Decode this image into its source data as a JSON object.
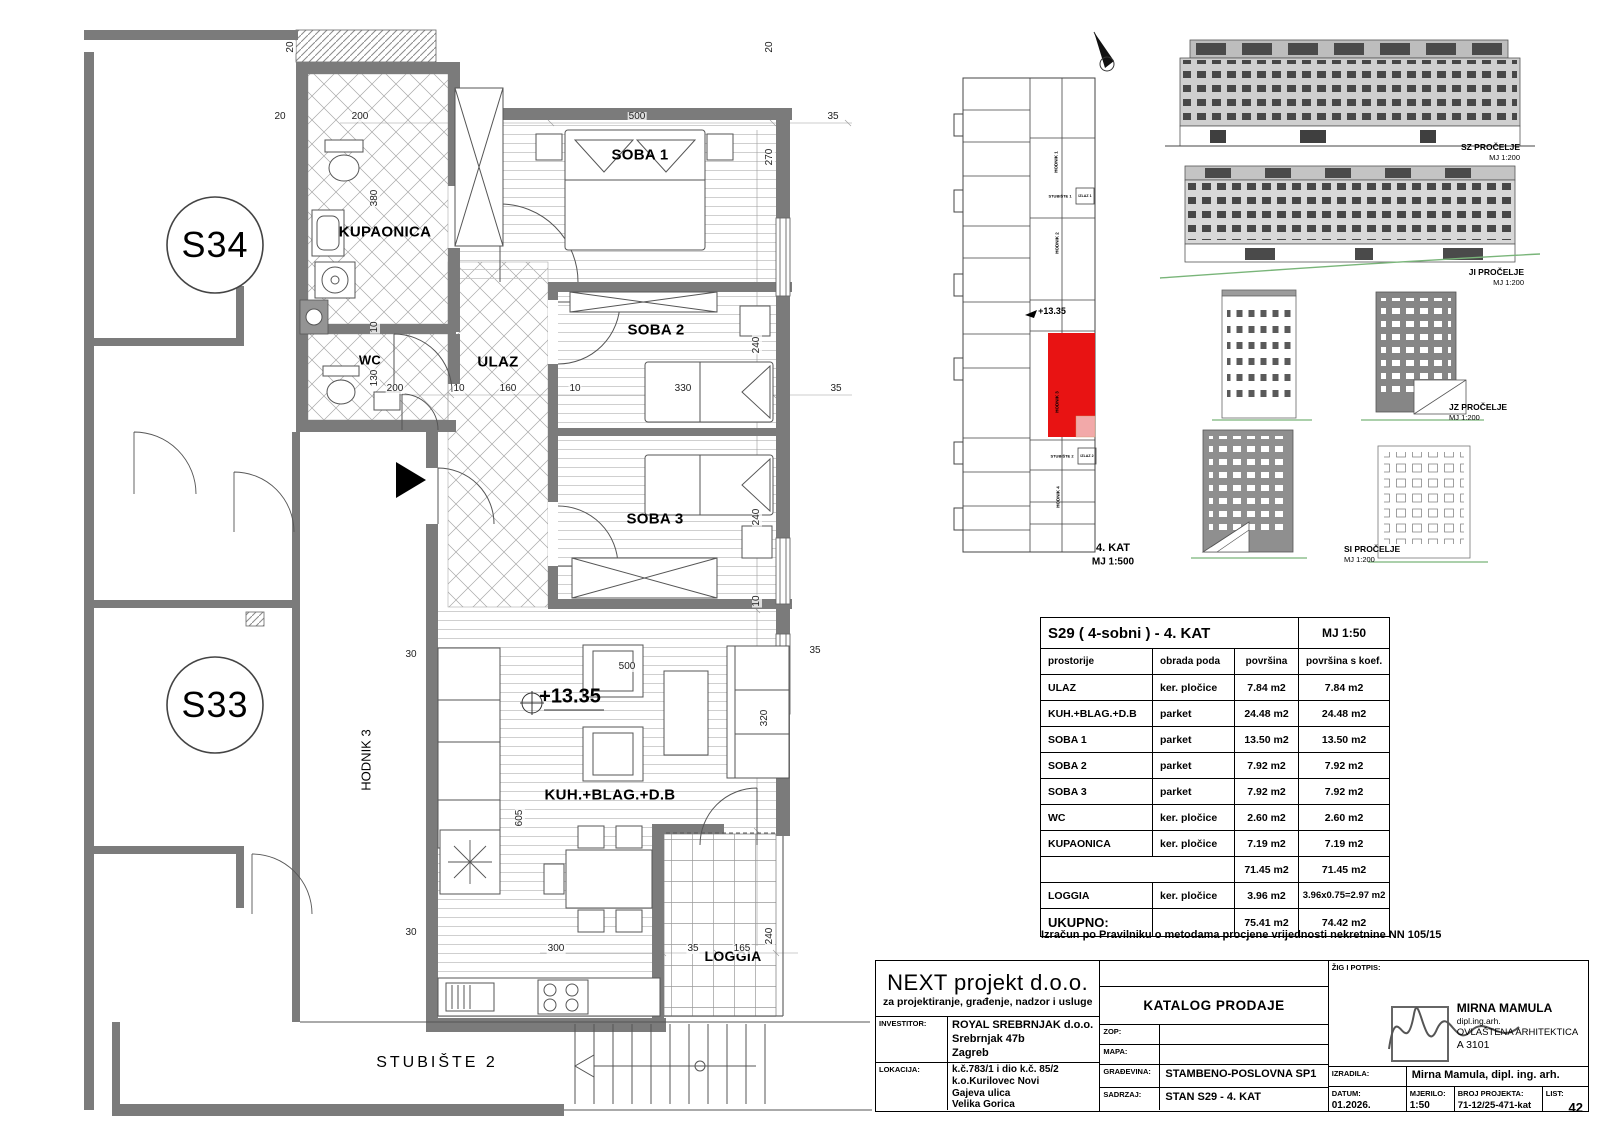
{
  "floor_plan": {
    "units": {
      "s34": "S34",
      "s33": "S33"
    },
    "rooms": {
      "kupaonica": "KUPAONICA",
      "wc": "WC",
      "ulaz": "ULAZ",
      "soba1": "SOBA 1",
      "soba2": "SOBA 2",
      "soba3": "SOBA 3",
      "kuh_blag_db": "KUH.+BLAG.+D.B",
      "loggia": "LOGGIA",
      "hodnik3": "HODNIK 3",
      "stubiste2": "STUBIŠTE 2"
    },
    "level_mark": "+13.35",
    "dims": [
      "20",
      "200",
      "20",
      "500",
      "270",
      "35",
      "20",
      "380",
      "10",
      "130",
      "200",
      "10",
      "160",
      "10",
      "330",
      "35",
      "240",
      "240",
      "10",
      "500",
      "30",
      "605",
      "320",
      "35",
      "300",
      "35",
      "165",
      "240",
      "30"
    ]
  },
  "key_plan": {
    "labels": {
      "hodnik1": "HODNIK 1",
      "stubiste1": "STUBIŠTE 1",
      "izlaz1": "IZLAZ 1",
      "hodnik2": "HODNIK 2",
      "hodnik3": "HODNIK 3",
      "stubiste2": "STUBIŠTE 2",
      "izlaz2": "IZLAZ 2",
      "hodnik4": "HODNIK 4"
    },
    "level_mark": "+13.35",
    "caption": "4. KAT",
    "caption_scale": "MJ 1:500",
    "highlight_color": "#e81313",
    "highlight_light": "#f2a9a9"
  },
  "elevations": {
    "e1": {
      "name": "SZ PROČELJE",
      "scale": "MJ 1:200"
    },
    "e2": {
      "name": "JI PROČELJE",
      "scale": "MJ 1:200"
    },
    "e3": {
      "name": "JZ PROČELJE",
      "scale": "MJ 1:200"
    },
    "e4": {
      "name": "SI PROČELJE",
      "scale": "MJ 1:200"
    }
  },
  "area_table": {
    "title": "S29 ( 4-sobni ) - 4. KAT",
    "scale": "MJ 1:50",
    "headers": [
      "prostorije",
      "obrada poda",
      "površina",
      "površina s koef."
    ],
    "rows": [
      [
        "ULAZ",
        "ker. pločice",
        "7.84 m2",
        "7.84 m2"
      ],
      [
        "KUH.+BLAG.+D.B",
        "parket",
        "24.48 m2",
        "24.48 m2"
      ],
      [
        "SOBA 1",
        "parket",
        "13.50 m2",
        "13.50 m2"
      ],
      [
        "SOBA 2",
        "parket",
        "7.92 m2",
        "7.92 m2"
      ],
      [
        "SOBA 3",
        "parket",
        "7.92 m2",
        "7.92 m2"
      ],
      [
        "WC",
        "ker. pločice",
        "2.60 m2",
        "2.60 m2"
      ],
      [
        "KUPAONICA",
        "ker. pločice",
        "7.19 m2",
        "7.19 m2"
      ],
      [
        "",
        "",
        "71.45 m2",
        "71.45 m2"
      ],
      [
        "LOGGIA",
        "ker. pločice",
        "3.96 m2",
        "3.96x0.75=2.97 m2"
      ],
      [
        "UKUPNO:",
        "",
        "75.41 m2",
        "74.42 m2"
      ]
    ],
    "note": "Izračun po Pravilniku o metodama procjene vrijednosti nekretnine  NN 105/15"
  },
  "title_block": {
    "company": "NEXT projekt d.o.o.",
    "company_sub": "za projektiranje, građenje, nadzor i usluge",
    "investitor_label": "INVESTITOR:",
    "investitor": [
      "ROYAL SREBRNJAK d.o.o.",
      "Srebrnjak 47b",
      "Zagreb"
    ],
    "lokacija_label": "LOKACIJA:",
    "lokacija": [
      "k.č.783/1 i dio k.č. 85/2",
      "k.o.Kurilovec Novi",
      "Gajeva ulica",
      "Velika Gorica"
    ],
    "catalog": "KATALOG PRODAJE",
    "zop_label": "ZOP:",
    "mapa_label": "MAPA:",
    "gradevina_label": "GRAĐEVINA:",
    "gradevina": "STAMBENO-POSLOVNA SP1",
    "sadrzaj_label": "SADRZAJ:",
    "sadrzaj": "STAN S29 - 4. KAT",
    "zig_label": "ŽIG I POTPIS:",
    "stamp_name": "MIRNA MAMULA",
    "stamp_title": "dipl.ing.arh.",
    "stamp_role": "OVLAŠTENA ARHITEKTICA",
    "stamp_number": "A 3101",
    "izradila_label": "IZRADILA:",
    "izradila": "Mirna Mamula, dipl. ing. arh.",
    "datum_label": "DATUM:",
    "datum": "01.2026.",
    "mjerilo_label": "MJERILO:",
    "mjerilo": "1:50",
    "broj_label": "BROJ PROJEKTA:",
    "broj": "71-12/25-471-kat",
    "list_label": "LIST:",
    "list": "42"
  }
}
